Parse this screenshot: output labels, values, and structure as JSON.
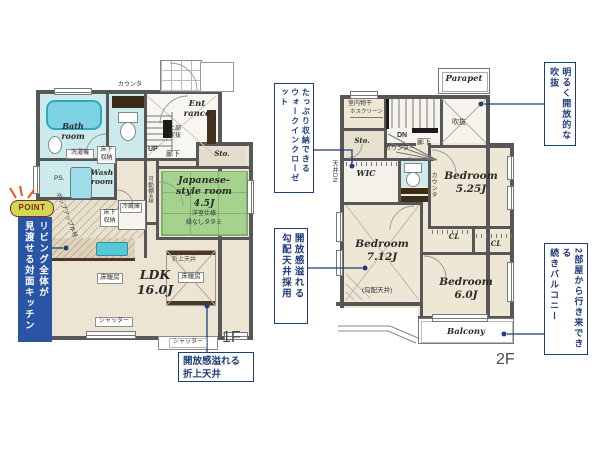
{
  "colors": {
    "wall": "#575757",
    "annotation_navy": "#1f3d7a",
    "room_beige": "#ece5d4",
    "wet_room_teal": "#cdeaed",
    "tatami_green": "#a5d28d",
    "fixture_teal": "#57c7d8",
    "cabinet_brown": "#42311d",
    "point_badge_bg": "#cfdb4f",
    "point_badge_text": "#8c2030",
    "point_box_bg": "#2a55a5",
    "spark_orange": "#e8541e"
  },
  "point_callout": {
    "badge": "POINT",
    "col_right": "リビング全体が",
    "col_left": "見渡せる対面キッチン"
  },
  "floor1": {
    "floor_label": "1F",
    "counter_top": "カウンタ",
    "bath_room_l1": "Bath",
    "bath_room_l2": "room",
    "entrance_l1": "Ent",
    "entrance_l2": "rance",
    "upper_void_l1": "上部",
    "upper_void_l2": "吹抜",
    "stairs_up": "UP",
    "hallway": "廊下",
    "storage": "Sto.",
    "washer": "洗濯機",
    "underfloor_storage_hall": "床下収納",
    "wash_room_l1": "Wash",
    "wash_room_l2": "room",
    "fridge": "冷蔵庫",
    "movable_shelf": "可動棚4段",
    "underfloor_storage_kitchen": "床下収納",
    "japanese_room_l1": "Japanese-",
    "japanese_room_l2": "style room",
    "japanese_room_l3": "4.5J",
    "japanese_room_note1": "洋室仕様",
    "japanese_room_note2": "縁なしタタミ",
    "ldk_l1": "LDK",
    "ldk_l2": "16.0J",
    "floor_heating_left": "床暖房",
    "coffered_ceiling": "折上天井",
    "floor_heating_center": "床暖房",
    "shutter_left": "シャッター",
    "shutter_bottom": "シャッター",
    "ps": "PS.",
    "popup_faucet": "ポップアップ水栓",
    "callout_coffered_l1": "開放感溢れる",
    "callout_coffered_l2": "折上天井"
  },
  "floor2": {
    "floor_label": "2F",
    "parapet": "Parapet",
    "indoor_drying": "室内物干",
    "indoor_drying_note": "ホスクリーン",
    "stairs_dn": "DN",
    "hallway": "廊下",
    "void": "吹抜",
    "storage": "Sto.",
    "counter_long": "カウンター",
    "wic": "WIC",
    "ceiling_dn": "天井DN",
    "counter_v": "カウンタ",
    "bedroom1_l1": "Bedroom",
    "bedroom1_l2": "5.25J",
    "bedroom2_l1": "Bedroom",
    "bedroom2_l2": "7.12J",
    "bedroom2_note": "(勾配天井)",
    "bedroom3_l1": "Bedroom",
    "bedroom3_l2": "6.0J",
    "closet1": "CL",
    "closet2": "CL",
    "balcony": "Balcony"
  },
  "callouts": {
    "wic_col_right": "たっぷり収納できる",
    "wic_col_left": "ウォークインクローゼット",
    "slope_col_right": "開放感溢れる",
    "slope_col_left": "勾配天井採用",
    "void_col_right": "明るく開放的な",
    "void_col_left": "吹抜",
    "balcony_col_right": "2部屋から行き来できる",
    "balcony_col_left": "続きバルコニー"
  }
}
